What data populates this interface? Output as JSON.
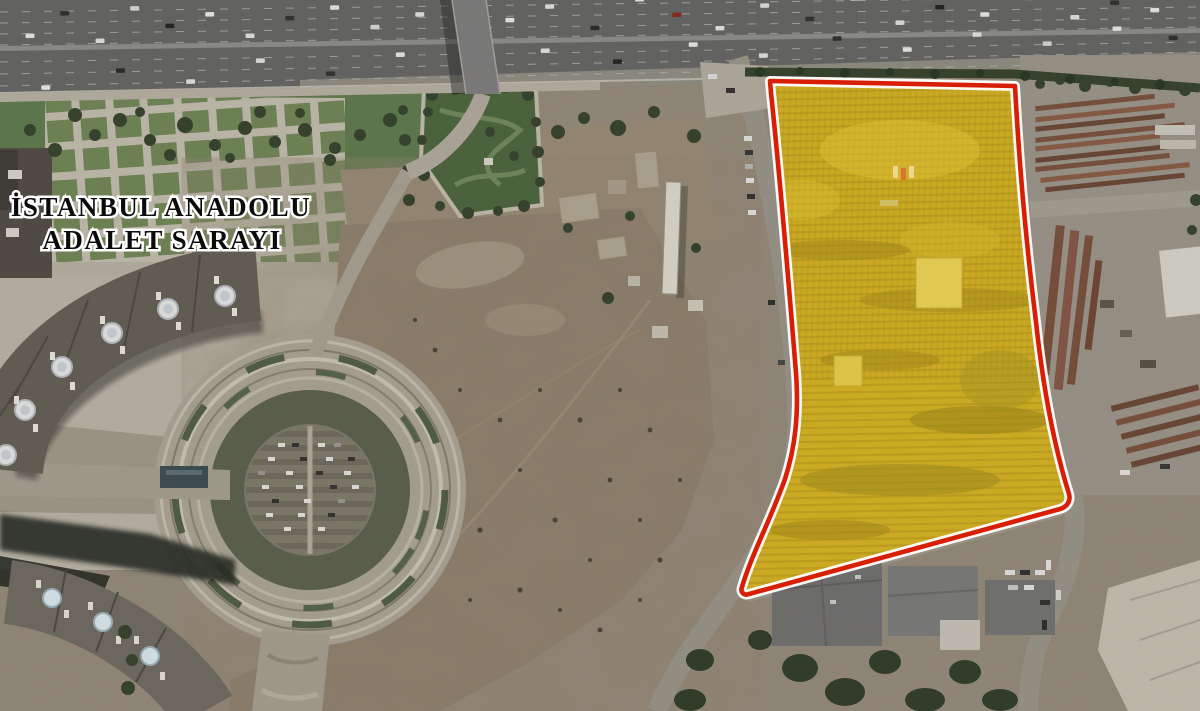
{
  "label": {
    "line1": "İSTANBUL ANADOLU",
    "line2": "ADALET SARAYI"
  },
  "parcel_overlay": {
    "fill": "#F3C70F",
    "fill_opacity": "0.34",
    "interior_base": "#B5992E",
    "stroke": "#D81E04",
    "casing": "#FFFFFF"
  },
  "scene": {
    "colors": {
      "highway": "#646464",
      "grass": "#5D7A4B",
      "dirt": "#8D7F6C",
      "plaza": "#C6C0B2",
      "road": "#9B968A",
      "tree": "#31402A",
      "roof": "#615D54",
      "shadow": "#232820",
      "industrial_pavement": "#9D968B",
      "stack_brown": "#7A4E3A"
    }
  }
}
